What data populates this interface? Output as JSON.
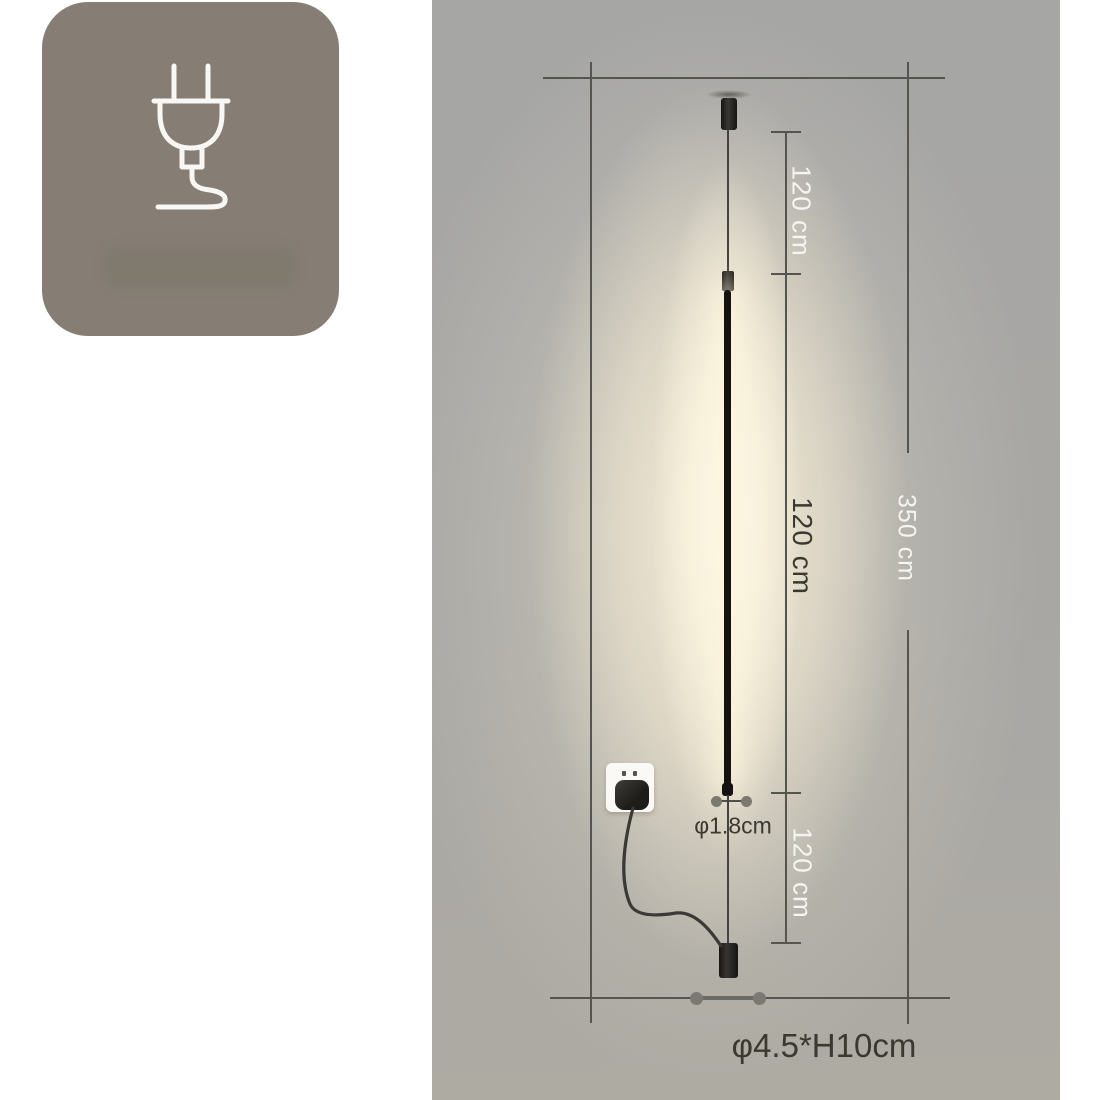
{
  "badge": {
    "icon": "power-plug-icon"
  },
  "labels": {
    "segment_top": "120 cm",
    "segment_middle": "120 cm",
    "segment_bottom": "120 cm",
    "total_height": "350 cm",
    "rod_diameter": "φ1.8cm",
    "base_size": "φ4.5*H10cm"
  },
  "colors": {
    "badge-bg": "#867e74",
    "panel-gray": "#a8a7a4",
    "glow-warm": "#f8f0db",
    "dim-line": "#56544f",
    "label-light": "#f6f5f1",
    "label-dark": "#3a382f",
    "lamp-black": "#141311"
  }
}
